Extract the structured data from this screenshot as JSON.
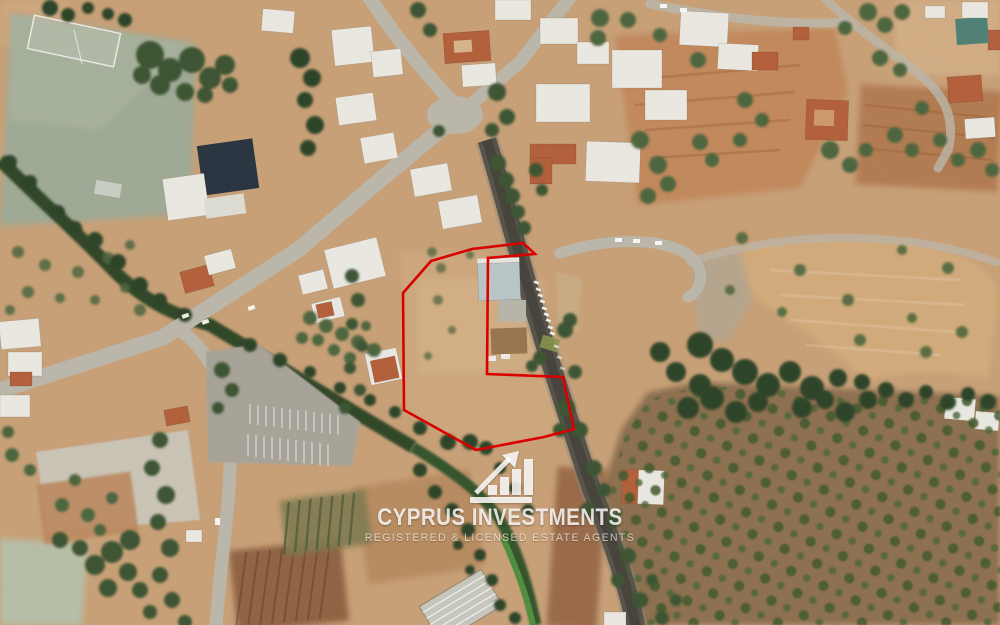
{
  "watermark": {
    "brand": "CYPRUS INVESTMENTS",
    "tagline": "REGISTERED & LICENSED ESTATE AGENTS",
    "logo_icon": "growth-bar-chart-arrow-icon",
    "text_color": "#ffffff"
  },
  "overlay": {
    "boundary_color": "#db0000"
  }
}
